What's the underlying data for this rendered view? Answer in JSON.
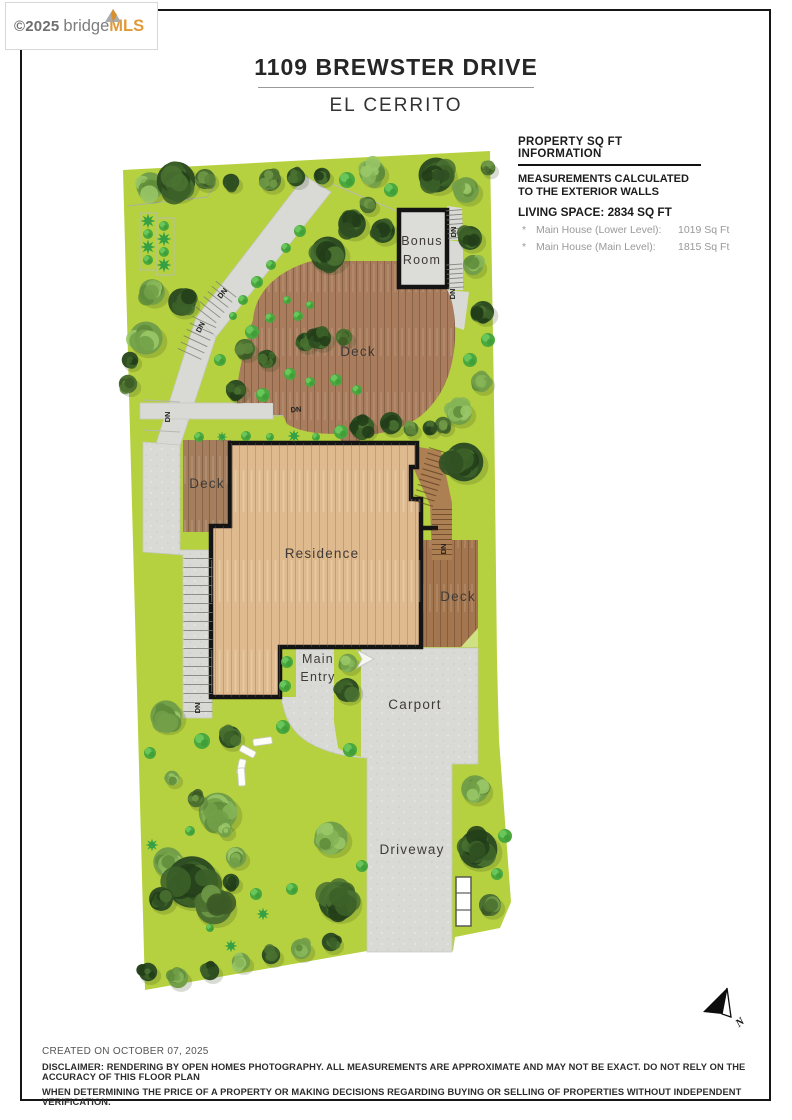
{
  "logo": {
    "copyright": "©2025",
    "brand_bridge": "bridge",
    "brand_mls": "MLS"
  },
  "header": {
    "title": "1109 BREWSTER DRIVE",
    "subtitle": "EL CERRITO"
  },
  "property_info": {
    "heading": "PROPERTY SQ FT INFORMATION",
    "measurements_line1": "MEASUREMENTS CALCULATED",
    "measurements_line2": "TO THE EXTERIOR WALLS",
    "living_space": "LIVING SPACE: 2834 SQ FT",
    "items": [
      {
        "bullet": "*",
        "label": "Main House (Lower Level):",
        "value": "1019 Sq Ft"
      },
      {
        "bullet": "*",
        "label": "Main House (Main Level):",
        "value": "1815 Sq Ft"
      }
    ]
  },
  "plan": {
    "labels": {
      "bonus_room_line1": "Bonus",
      "bonus_room_line2": "Room",
      "deck": "Deck",
      "residence": "Residence",
      "main_entry_line1": "Main",
      "main_entry_line2": "Entry",
      "carport": "Carport",
      "driveway": "Driveway",
      "dn": "DN",
      "north": "N"
    },
    "colors": {
      "lawn": "#b6d13f",
      "concrete": "#d9dad5",
      "deck_wood": "#a87c5c",
      "residence_wood": "#deba8e",
      "outline": "#141414",
      "logo_accent": "#e09a39"
    }
  },
  "footer": {
    "created": "CREATED ON OCTOBER 07, 2025",
    "disclaimer_line1": "DISCLAIMER: RENDERING BY OPEN HOMES PHOTOGRAPHY. ALL MEASUREMENTS ARE APPROXIMATE AND MAY NOT BE EXACT. DO NOT RELY ON THE ACCURACY OF THIS FLOOR PLAN",
    "disclaimer_line2": "WHEN DETERMINING THE PRICE OF A PROPERTY OR MAKING DECISIONS REGARDING BUYING OR SELLING OF PROPERTIES WITHOUT INDEPENDENT VERIFICATION."
  }
}
